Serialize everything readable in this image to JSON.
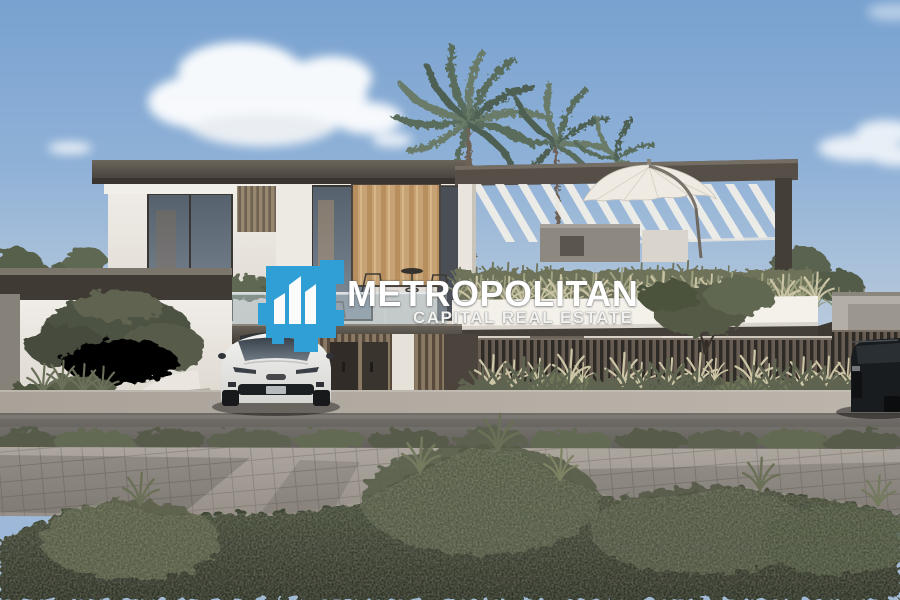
{
  "watermark": {
    "brand": "METROPOLITAN",
    "tagline": "CAPITAL REAL ESTATE",
    "logo_color": "#2f9fd6",
    "text_color": "#ffffff"
  },
  "palette": {
    "sky_top": "#79a2d0",
    "sky_horizon": "#cdd7e0",
    "roof_slab": "#4a443e",
    "wall_white": "#e9e6e0",
    "wood_slat": "#8a7a64",
    "warm_glass": "#c79b66",
    "fence_slat": "#675d52",
    "foliage_dark": "#49503e",
    "asphalt": "#6e6a65",
    "paver": "#a29c94",
    "white_car": "#e9e9e9"
  }
}
